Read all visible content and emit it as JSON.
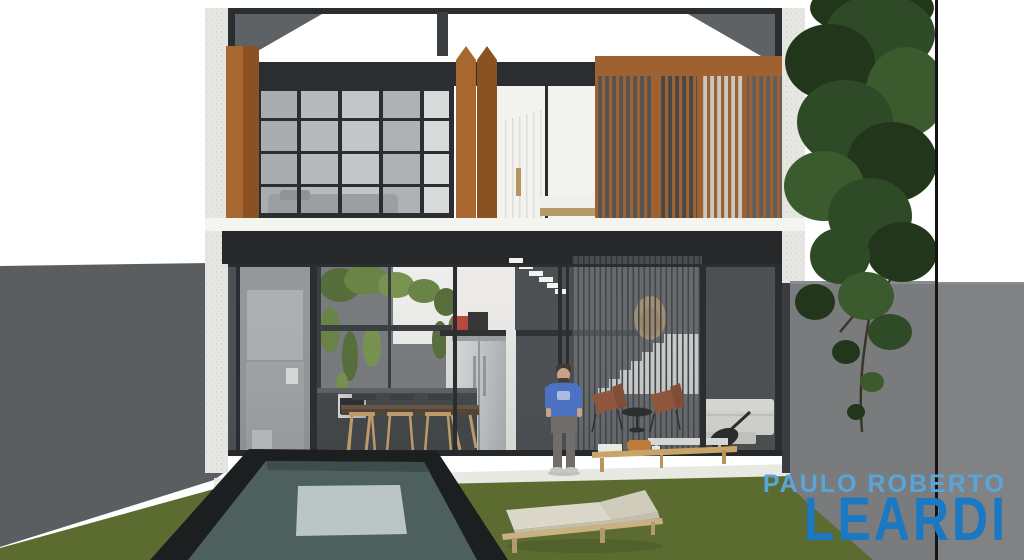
{
  "meta": {
    "width": 1024,
    "height": 560,
    "kind": "3d-architectural-rendering",
    "scene_title": "Modern two-story house elevation with pool and garden"
  },
  "watermark": {
    "line1": "PAULO ROBERTO",
    "line2": "LEARDI"
  },
  "scene_objects": [
    "two-story house facade",
    "concrete side columns",
    "roof beam with corner braces",
    "wood folding shutters",
    "upper bedroom window grid",
    "wood slat screen over bedroom",
    "ground floor glass wall",
    "interior courtyard plants",
    "kitchen with fridge and island",
    "dining table with chairs",
    "floating stair treads and staircase",
    "stair slat screen",
    "leather armchairs",
    "light sofa with guitar",
    "outdoor wood coffee table",
    "standing man in blue t-shirt",
    "lap pool",
    "lawn",
    "white patio edge",
    "left boundary wall",
    "right boundary wall",
    "tree foliage"
  ],
  "colors": {
    "sky": "#ffffff",
    "concrete": "#e6e6e2",
    "frame_dark": "#2b2e30",
    "roof_wedge": "#5e6264",
    "wood_warm": "#a8672f",
    "wood_shadow": "#8a5123",
    "wood_slat": "#9f6130",
    "glass_light": "#b6babc",
    "glass_mid": "#8d9092",
    "interior_dark": "#3e4245",
    "interior_header": "#26282a",
    "white_wall": "#f2f2ef",
    "slab_white": "#f4f4f1",
    "left_wall": "#5b5e60",
    "right_wall": "#797b7d",
    "grass": "#5c6c31",
    "pool_rim": "#1b1f20",
    "pool_water": "#4e605e",
    "pool_light": "#c8d4d3",
    "patio": "#e9e9e4",
    "steel": "#c6c9cb",
    "wood_furniture": "#c49a5f",
    "table_top": "#483526",
    "leather": "#8a4a2c",
    "sofa": "#d6d6d1",
    "tree_green": "#2f4a26",
    "tree_green_dark": "#22361b",
    "shirt_blue": "#4e72c2",
    "pants": "#716d6a",
    "skin": "#c9a287",
    "lounger_cushion": "#dbd7c9",
    "lounger_frame": "#c8b183",
    "red_appliance": "#b5392c",
    "watermark_light": "#58a6d9",
    "watermark_bold": "#1b78c2"
  }
}
